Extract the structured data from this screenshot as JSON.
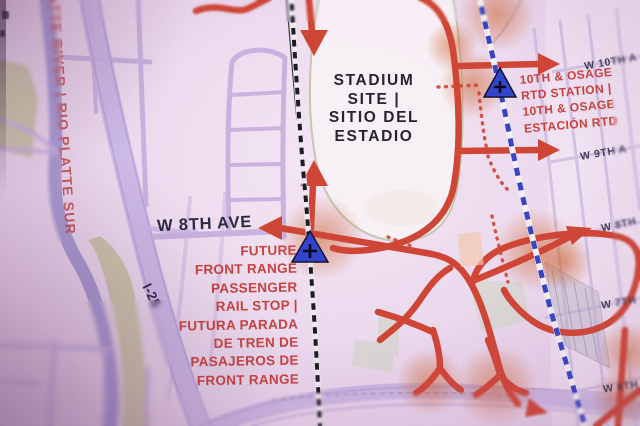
{
  "map": {
    "labels": {
      "stadium": {
        "line1": "STADIUM",
        "line2": "SITE |",
        "line3": "SITIO DEL",
        "line4": "ESTADIO"
      },
      "river": "ATTE RIVER | RIO PLATTE SUR",
      "w8th_ave": "W 8TH AVE",
      "i25": "I-25",
      "streets": {
        "w10th": "W 10TH A",
        "w9th": "W 9TH A",
        "w8th": "W 8TH",
        "w7th": "W 7TH",
        "w6th": "W 6TH"
      },
      "osage_station": {
        "line1": "10TH & OSAGE",
        "line2": "RTD STATION |",
        "line3": "10TH & OSAGE",
        "line4": "ESTACIÓN RTD"
      },
      "future_rail_stop": {
        "line1": "FUTURE",
        "line2": "FRONT RANGE",
        "line3": "PASSENGER",
        "line4": "RAIL STOP |",
        "line5": "FUTURA PARADA",
        "line6": "DE TREN DE",
        "line7": "PASAJEROS DE",
        "line8": "FRONT RANGE"
      }
    },
    "colors": {
      "background": "#ecdaee",
      "route_red": "#cf4637",
      "text_red": "#c9413c",
      "text_navy": "#2c2a40",
      "road_purple": "#c5aede",
      "river_purple": "#9b8ecc",
      "park_olive": "#c2bd96",
      "rail_dash_black": "#1c1b26",
      "rtd_line_blue": "#2636c0",
      "station_marker_blue": "#3344cc",
      "glow_orange": "#d26932",
      "stadium_fill": "#f8f1f6"
    }
  }
}
